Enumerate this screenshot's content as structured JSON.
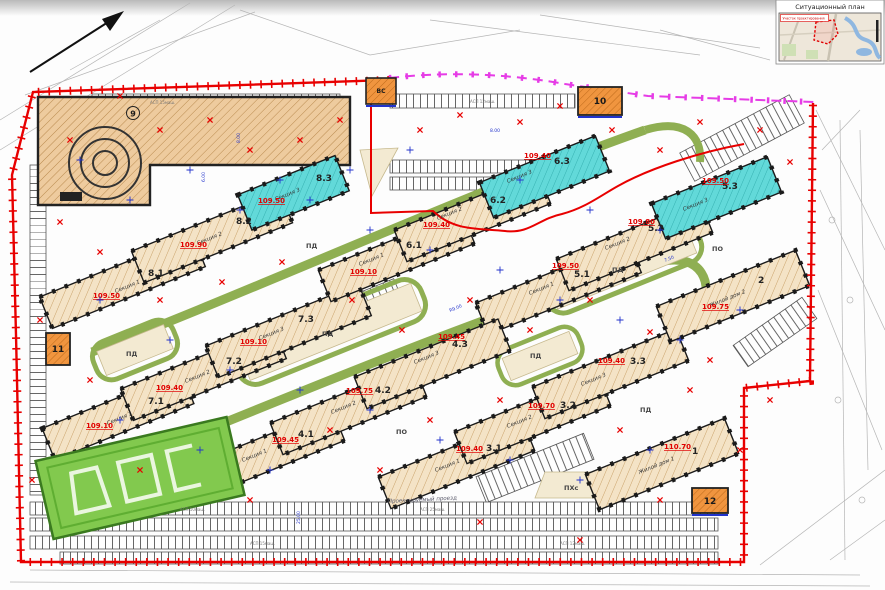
{
  "inset": {
    "title": "Ситуационный план",
    "plot_label": "Участок проектирования"
  },
  "buildings": [
    {
      "id": "8.1",
      "name": "Секция 1",
      "elevation": "109.50"
    },
    {
      "id": "8.2",
      "name": "Секция 2",
      "elevation": "109.90"
    },
    {
      "id": "8.3",
      "name": "Секция 3",
      "elevation": "109.50"
    },
    {
      "id": "7.1",
      "name": "Секция 1",
      "elevation": "109.10"
    },
    {
      "id": "7.2",
      "name": "Секция 2",
      "elevation": "109.40"
    },
    {
      "id": "7.3",
      "name": "Секция 3",
      "elevation": "109.10"
    },
    {
      "id": "6.1",
      "name": "Секция 1",
      "elevation": "109.10"
    },
    {
      "id": "6.2",
      "name": "Секция 2",
      "elevation": "109.40"
    },
    {
      "id": "6.3",
      "name": "Секция 3",
      "elevation": "109.40"
    },
    {
      "id": "5.1",
      "name": "Секция 1",
      "elevation": "109.50"
    },
    {
      "id": "5.2",
      "name": "Секция 2",
      "elevation": "109.80"
    },
    {
      "id": "5.3",
      "name": "Секция 3",
      "elevation": "109.50"
    },
    {
      "id": "4.1",
      "name": "Секция 1",
      "elevation": "109.45"
    },
    {
      "id": "4.2",
      "name": "Секция 2",
      "elevation": "109.75"
    },
    {
      "id": "4.3",
      "name": "Секция 3",
      "elevation": "109.45"
    },
    {
      "id": "3.1",
      "name": "Секция 1",
      "elevation": "109.40"
    },
    {
      "id": "3.2",
      "name": "Секция 2",
      "elevation": "109.70"
    },
    {
      "id": "3.3",
      "name": "Секция 3",
      "elevation": "109.40"
    },
    {
      "id": "2",
      "name": "Жилой дом 2",
      "elevation": "109.75"
    },
    {
      "id": "1",
      "name": "Жилой дом 1",
      "elevation": "110.70"
    }
  ],
  "facilities": {
    "b9": "9",
    "b10": "10",
    "b11": "11",
    "b12": "12",
    "vs": "ВС"
  },
  "zones": {
    "pd": "ПД",
    "po": "ПО",
    "phs": "ПХс"
  },
  "parking_labels": [
    "АСП 15маш.",
    "АСП 12маш.",
    "АСП 10маш.",
    "АСП 25маш."
  ],
  "dimensions": [
    "6.00",
    "8.00",
    "25.00",
    "7.50",
    "R9.00"
  ],
  "road_label": "Проектируемый проезд",
  "colors": {
    "boundary_red": "#e80000",
    "redline_magenta": "#e63ce6",
    "road_green": "#8faf52",
    "building_beige": "#f4e3c6",
    "building_cyan": "#62d9d9",
    "utility_orange": "#f0953f",
    "annotation_blue": "#2233cc",
    "elevation_red": "#e10000",
    "field_green": "#82c94e"
  }
}
